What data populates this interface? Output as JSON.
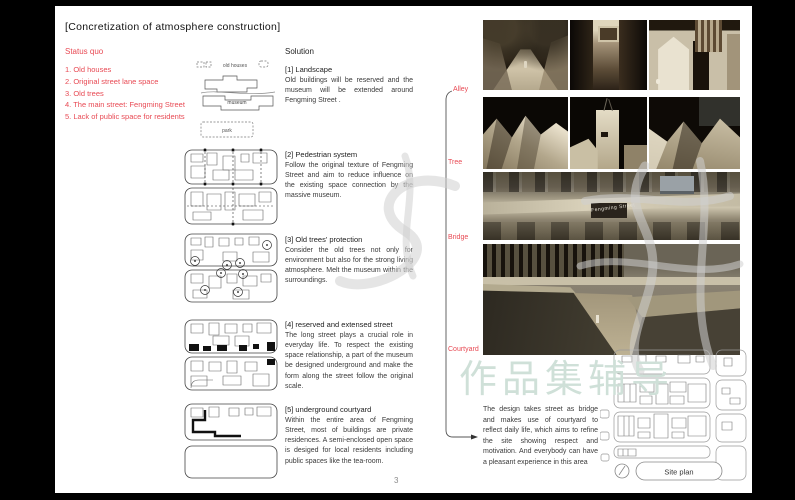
{
  "page": {
    "title": "[Concretization of atmosphere construction]",
    "page_number": "3"
  },
  "status_quo": {
    "heading": "Status quo",
    "items": [
      "1. Old houses",
      "2. Original street lane space",
      "3. Old trees",
      "4. The main street: Fengming Street",
      "5. Lack of public space for residents"
    ]
  },
  "diagram_labels": {
    "old_houses": "old houses",
    "museum": "museum",
    "park": "park"
  },
  "solution": {
    "heading": "Solution",
    "sections": [
      {
        "label": "[1] Landscape",
        "body": "Old buildings will be reserved and the museum will be extended around Fengming Street ."
      },
      {
        "label": "[2] Pedestrian system",
        "body": "Follow the original texture of Fengming Street and aim to reduce influence on the existing space connection by the massive museum."
      },
      {
        "label": "[3] Old trees' protection",
        "body": "Consider the old trees not only for environment but also for the strong living atmosphere. Melt the museum within the surroundings."
      },
      {
        "label": "[4] reserved and extensed street",
        "body": "The long street plays a crucial role in everyday life. To respect the existing space relationship, a part of the museum be designed underground and make the form along the street follow the original scale."
      },
      {
        "label": "[5] underground courtyard",
        "body": "Within the entire area of Fengming Street, most of buildings are private residences. A semi-enclosed open space is desiged for local residents including public spaces like the tea-room."
      }
    ]
  },
  "connector": {
    "labels": [
      "Alley",
      "Tree",
      "Bridge",
      "Courtyard"
    ]
  },
  "conclusion": "The design takes street as bridge and makes use of courtyard to reflect daily life, which aims to refine the site showing respect and motivation. And everybody can have a pleasant experience in this area",
  "photos": {
    "street_label": "Fengming Street"
  },
  "site_plan": {
    "label": "Site plan"
  },
  "watermark": {
    "text": "作品集辅导",
    "color": "#cfe0d8"
  },
  "colors": {
    "accent_red": "#e84a54",
    "page_background": "#ffffff",
    "frame": "#000000"
  }
}
